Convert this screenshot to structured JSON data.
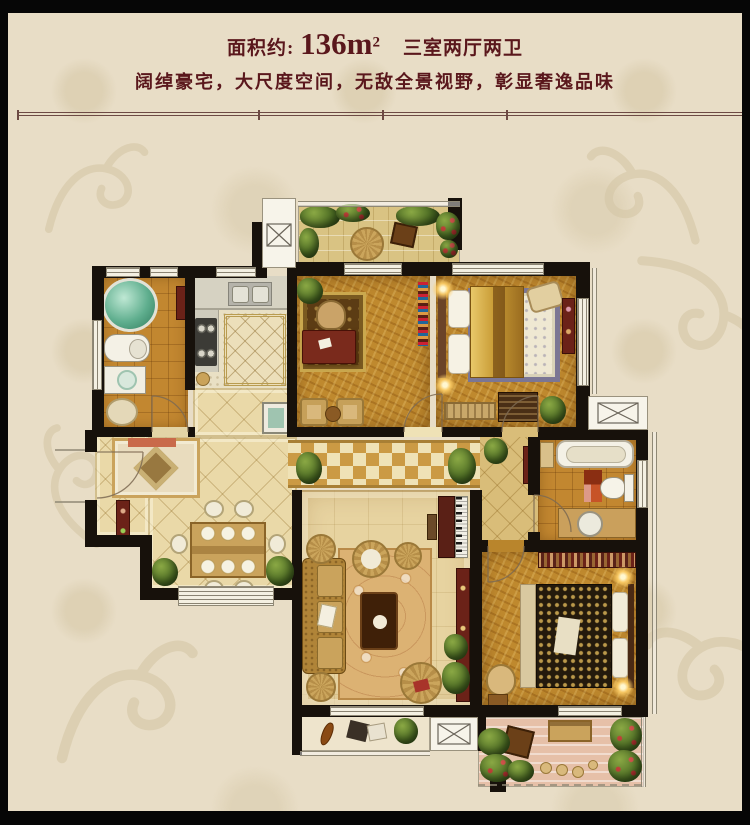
{
  "header": {
    "area_label": "面积约:",
    "area_value": "136m",
    "area_exponent": "2",
    "room_config": "三室两厅两卫",
    "tagline": "阔绰豪宅，大尺度空间，无敌全景视野，彰显奢逸品味"
  },
  "floorplan": {
    "rooms": [
      "north-balcony",
      "kitchen",
      "bathroom",
      "study",
      "bedroom",
      "hallway",
      "foyer",
      "dining-room",
      "living-room",
      "master-bathroom",
      "master-bedroom",
      "living-balcony",
      "master-balcony"
    ],
    "fixtures": [
      "shower",
      "toilet",
      "washer",
      "double-sink",
      "stove",
      "island",
      "desk",
      "bookshelf",
      "double-bed",
      "wardrobe",
      "bathtub",
      "vanity-sink",
      "piano",
      "sofa",
      "coffee-table",
      "dining-table",
      "tv-console"
    ]
  },
  "colors": {
    "frame": "#060606",
    "background": "#e8ddc6",
    "damask_pattern": "#d5c7a6",
    "title_text": "#5a171c",
    "rule_line": "#6d4a44",
    "wall": "#17110b",
    "wood_floor": "#bf892e",
    "marble_floor": "#ead9a8",
    "tile_floor": "#c28730",
    "checker_diamond": "#cb9a44",
    "balcony_tile": "#d9c383",
    "balcony_pink": "#e6c0a8",
    "greenery": "#4a6a22",
    "shower_glass": "#5fae8e",
    "furniture_red": "#6b2218"
  }
}
